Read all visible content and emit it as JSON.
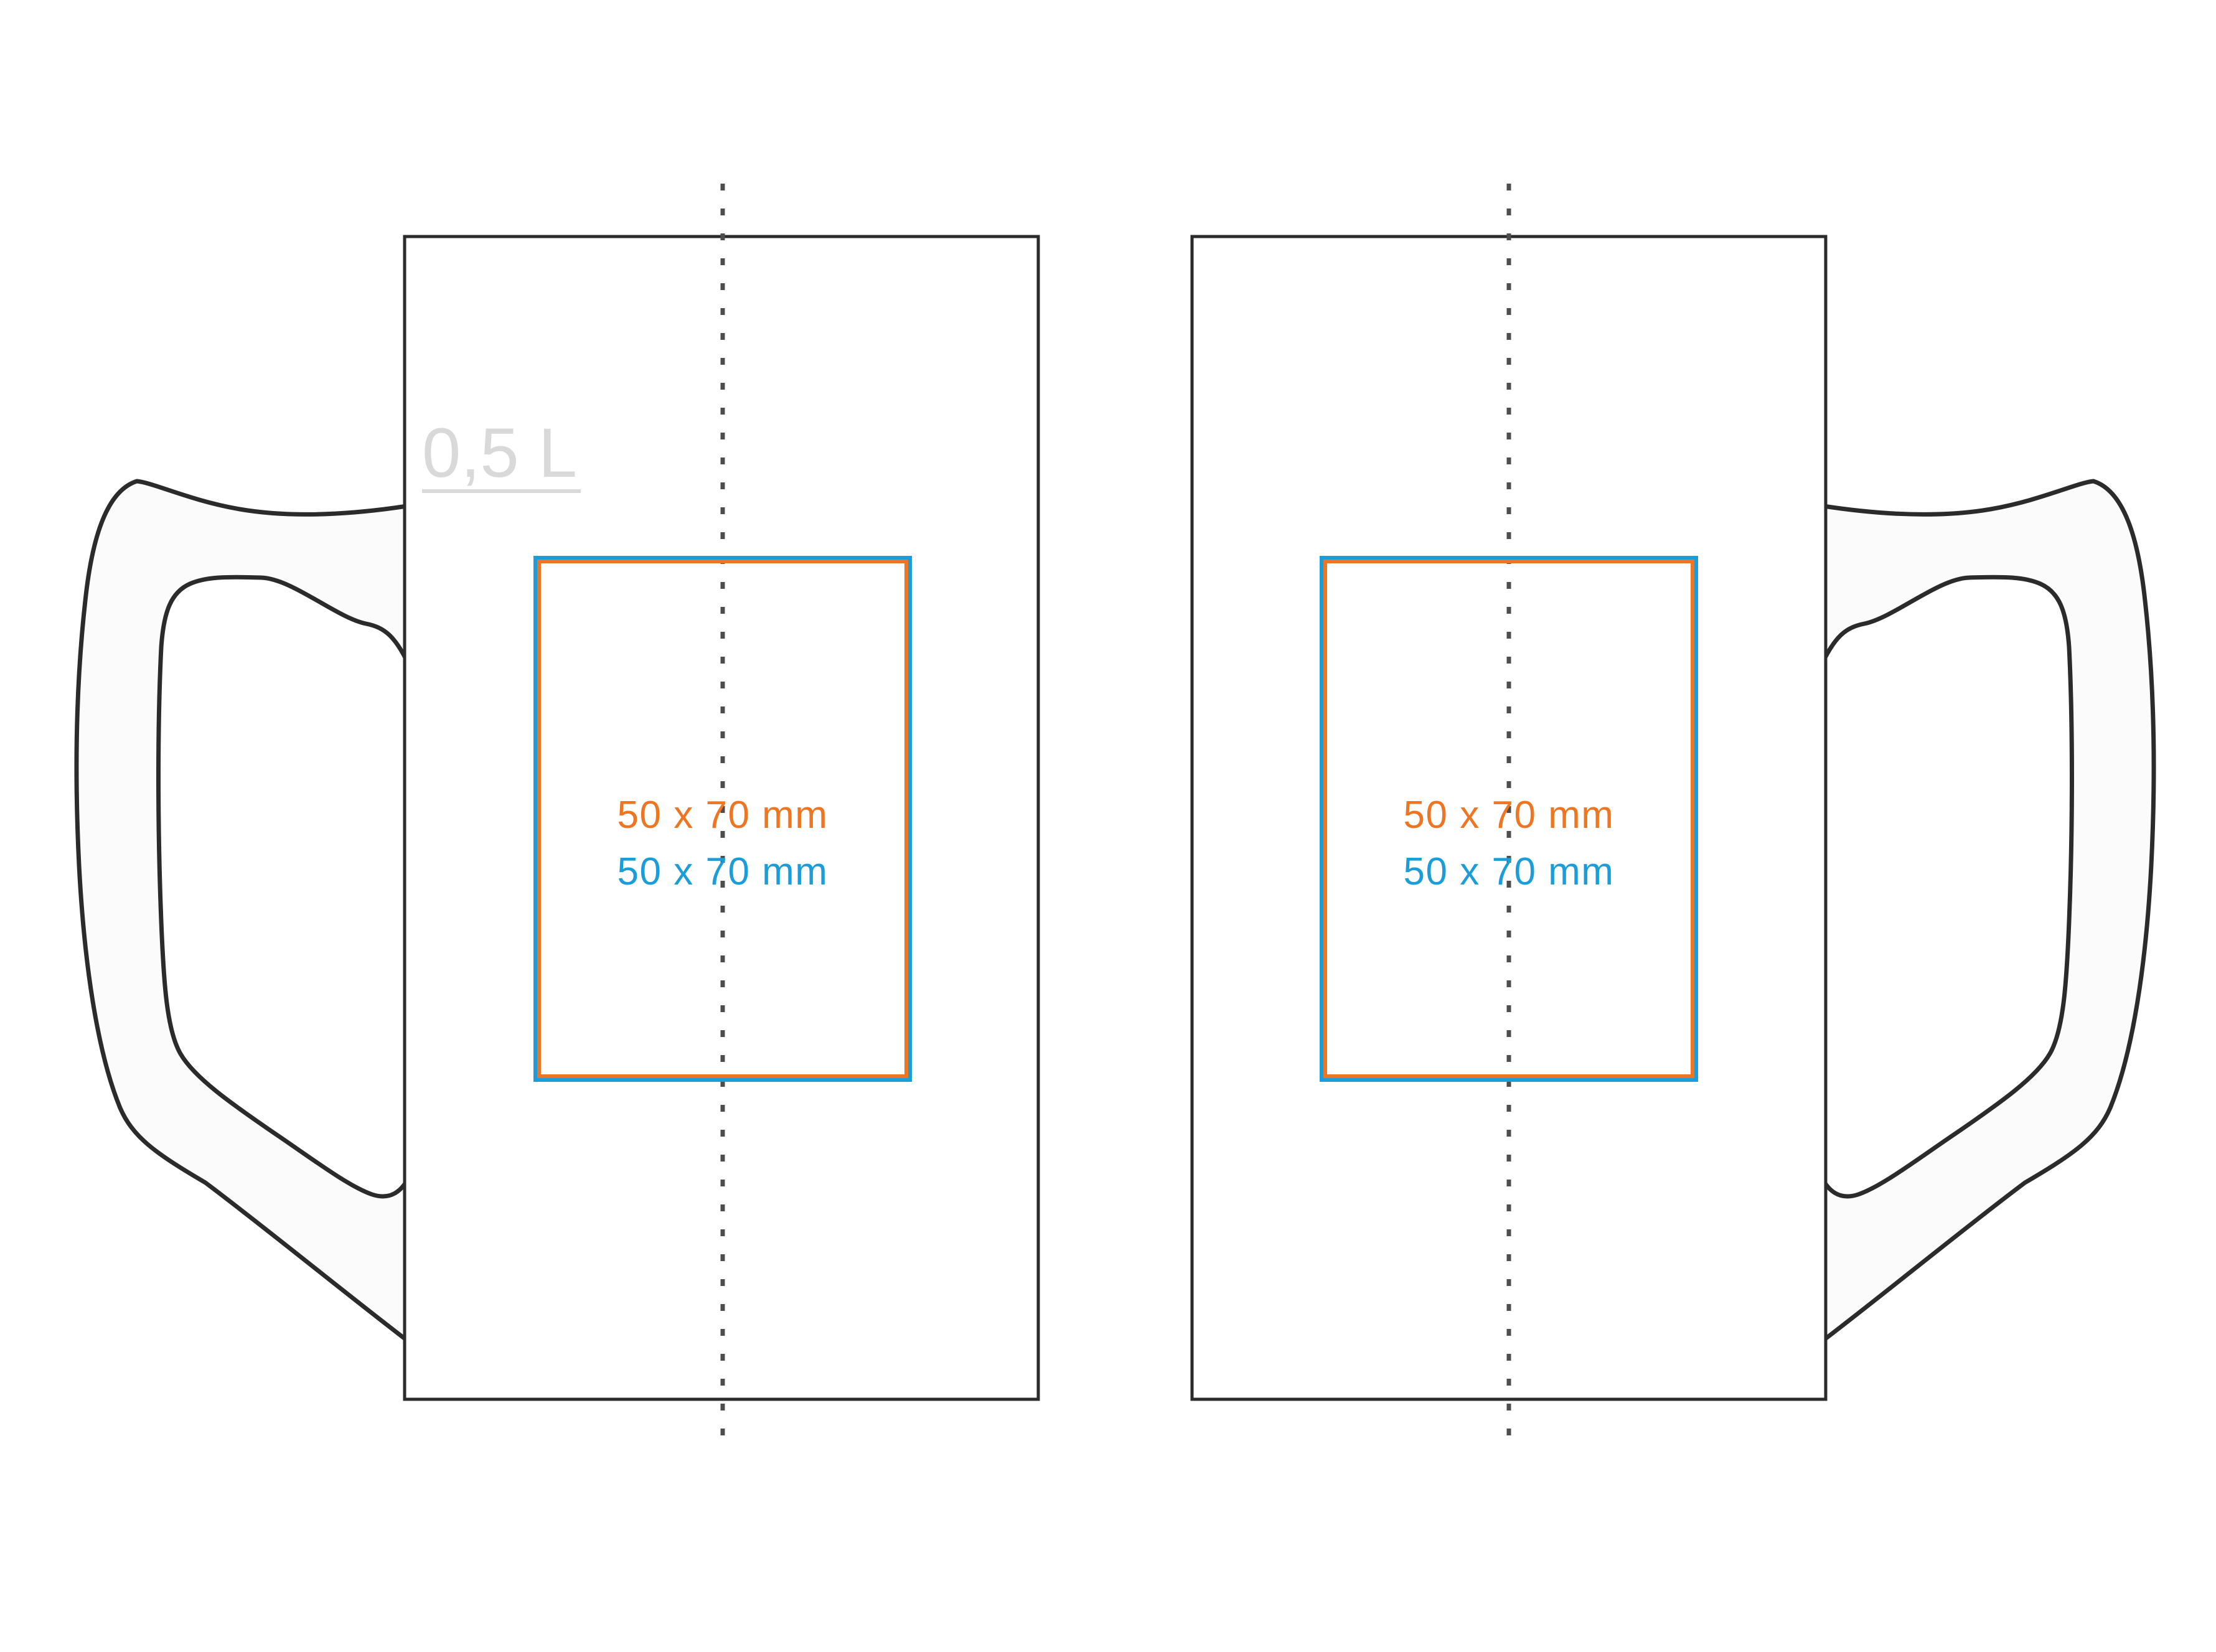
{
  "template": {
    "kind": "mug print-area template",
    "views": [
      "front",
      "back"
    ]
  },
  "colors": {
    "background": "#ffffff",
    "mug_outline": "#2b2b2b",
    "handle_fill": "#fbfbfb",
    "center_dash": "#4d4d4d",
    "print_area_outer_blue": "#1b9dd9",
    "print_area_inner_orange": "#ee7623",
    "capacity_label_gray": "#d9d9d9"
  },
  "mugs": {
    "front": {
      "capacity": "0,5 L",
      "print_area": {
        "orange_label": "50 x 70 mm",
        "blue_label": "50 x 70 mm"
      }
    },
    "back": {
      "print_area": {
        "orange_label": "50 x 70 mm",
        "blue_label": "50 x 70 mm"
      }
    }
  }
}
